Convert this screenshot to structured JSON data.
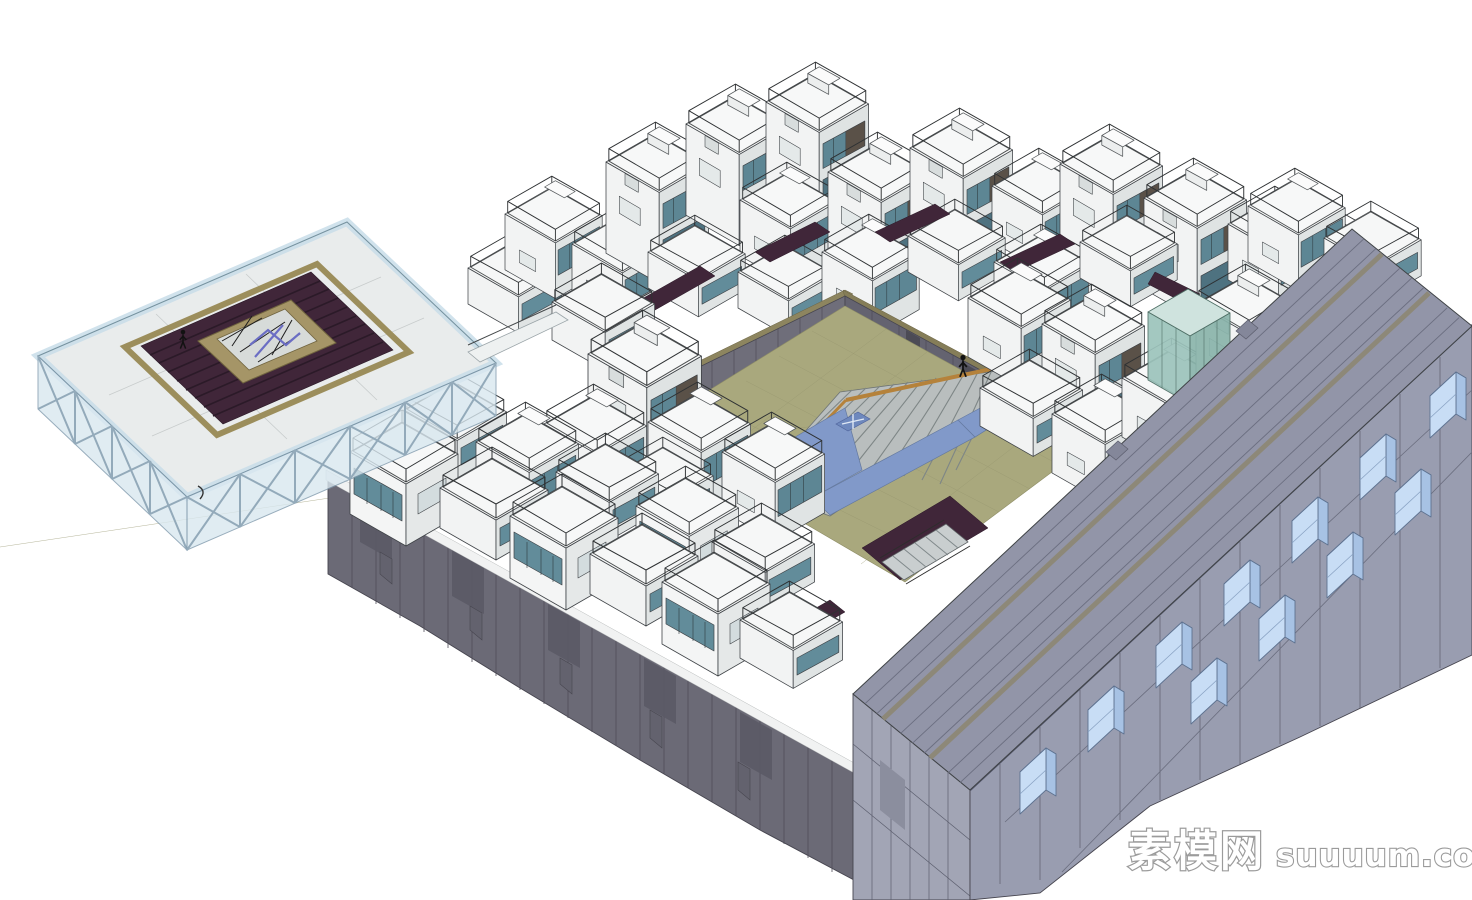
{
  "watermark": {
    "brand": "素模网",
    "domain": "suuuum.com",
    "text_color": "#ffffff",
    "outline_color": "#989898"
  },
  "scene": {
    "type": "3D architectural model rendering, SketchUp style",
    "view": "aerial axonometric",
    "subject": "White modular housing blocks around a central courtyard with a stepped plaza and water channels, a glass-truss roof pavilion at left, a dark panelled podium along the street edge and a long slab building with projecting glass bay windows at right",
    "background": "#ffffff",
    "elements": [
      {
        "name": "glass-roof-pavilion",
        "label": "Glass truss pavilion with rooftop deck"
      },
      {
        "name": "pavilion-roof-deck",
        "label": "Dark red timber roof deck with skylight truss opening"
      },
      {
        "name": "modular-house",
        "label": "White modular house with glass-railed roof terrace",
        "count": 45
      },
      {
        "name": "courtyard",
        "label": "Central courtyard plaza"
      },
      {
        "name": "amphitheater-steps",
        "label": "Stepped amphitheatre with timber handrail"
      },
      {
        "name": "water-channel",
        "label": "Reflecting pool channels with cross marker"
      },
      {
        "name": "perimeter-wall",
        "label": "Dark grey panelled courtyard wall"
      },
      {
        "name": "podium-wall",
        "label": "Dark grey panelled street podium"
      },
      {
        "name": "slab-building",
        "label": "Long slab building with projecting glass bay windows"
      },
      {
        "name": "glass-elevator-box",
        "label": "Green glass lift and stair box"
      },
      {
        "name": "human-figure",
        "label": "Scale figure",
        "count": 2
      }
    ]
  },
  "palette": {
    "background": "#ffffff",
    "house_white": "#f6f7f7",
    "house_shadow": "#dfe3e3",
    "glass_teal": "#5d8694",
    "louver_brown": "#5a5148",
    "courtyard_ground": "#a9a87d",
    "wall_grey": "#6f6e7a",
    "podium_grey": "#6b6a76",
    "slab_grey": "#9295a8",
    "bay_glass_blue": "#c8ddf5",
    "pavilion_glass": "#d9e8f0",
    "deck_maroon": "#402639",
    "trim_tan": "#9c8e5c",
    "water_blue": "#8199c9",
    "timber_rail": "#b5823b",
    "truss_blue": "#6b6ec4"
  }
}
